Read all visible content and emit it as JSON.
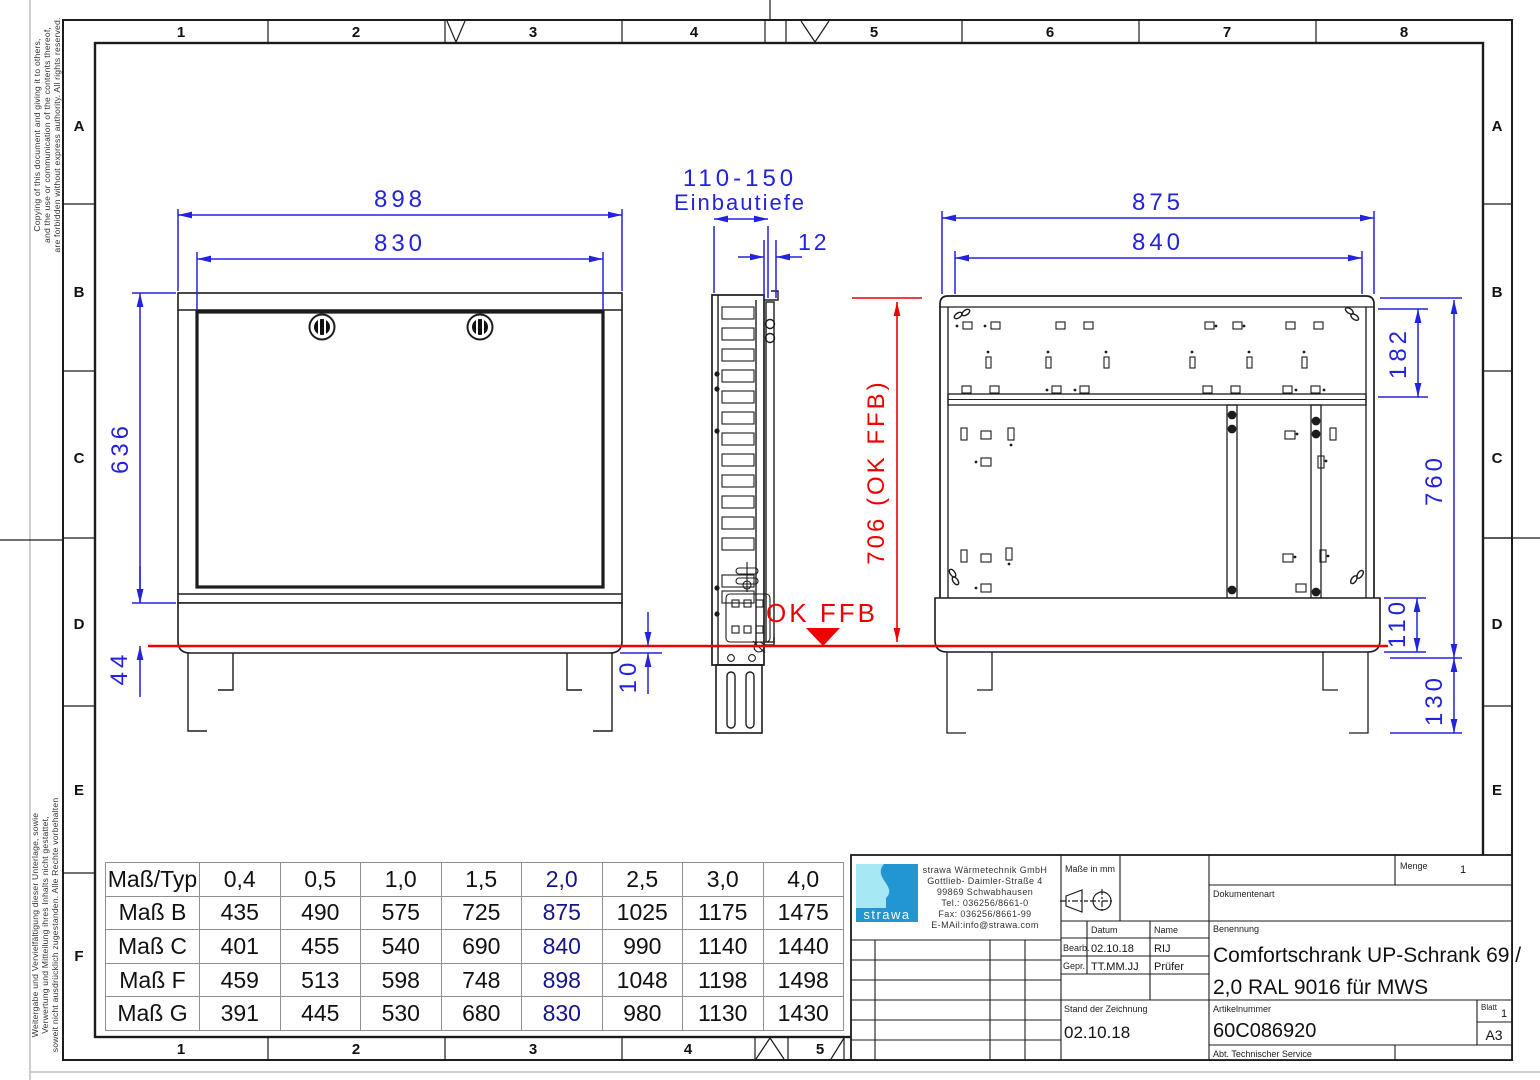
{
  "colors": {
    "dim_blue": "#2323dd",
    "datum_red": "#ee0000",
    "table_highlight": "#14148c",
    "line": "#1c1c1c",
    "logo_cyan": "#a5e7f3",
    "logo_blue": "#2196d3"
  },
  "border": {
    "top_cols": [
      "1",
      "2",
      "3",
      "4",
      "5",
      "6",
      "7",
      "8"
    ],
    "bottom_cols": [
      "1",
      "2",
      "3",
      "4",
      "5"
    ],
    "left_rows": [
      "A",
      "B",
      "C",
      "D",
      "E",
      "F"
    ],
    "right_rows": [
      "A",
      "B",
      "C",
      "D",
      "E"
    ]
  },
  "notices": {
    "top_lines": [
      "Copying of this document and giving it to others,",
      "and the use or communication of the contents thereof,",
      "are forbidden without express authority. All rights reserved."
    ],
    "bottom_lines": [
      "Weitergabe und Vervielfältigung dieser Unterlage, sowie",
      "Verwertung und Mitteilung ihres Inhalts nicht gestattet,",
      "soweit nicht ausdrücklich zugestanden. Alle Rechte vorbehalten"
    ]
  },
  "front_view": {
    "dim_outer_width": "898",
    "dim_door_width": "830",
    "dim_height": "636",
    "dim_base": "44",
    "dim_floor_gap": "10"
  },
  "side_view": {
    "dim_depth": "110-150",
    "dim_depth_label": "Einbautiefe",
    "dim_door_thickness": "12"
  },
  "rear_view": {
    "dim_outer_width": "875",
    "dim_inner_width": "840",
    "dim_top_zone": "182",
    "dim_height": "760",
    "dim_base_height": "110",
    "dim_leg_height": "130"
  },
  "datum": {
    "height_label": "706 (OK FFB)",
    "floor_label": "OK FFB"
  },
  "size_table": {
    "header": [
      "Maß/Typ",
      "0,4",
      "0,5",
      "1,0",
      "1,5",
      "2,0",
      "2,5",
      "3,0",
      "4,0"
    ],
    "rows": [
      {
        "label": "Maß B",
        "values": [
          "435",
          "490",
          "575",
          "725",
          "875",
          "1025",
          "1175",
          "1475"
        ]
      },
      {
        "label": "Maß C",
        "values": [
          "401",
          "455",
          "540",
          "690",
          "840",
          "990",
          "1140",
          "1440"
        ]
      },
      {
        "label": "Maß F",
        "values": [
          "459",
          "513",
          "598",
          "748",
          "898",
          "1048",
          "1198",
          "1498"
        ]
      },
      {
        "label": "Maß G",
        "values": [
          "391",
          "445",
          "530",
          "680",
          "830",
          "980",
          "1130",
          "1430"
        ]
      }
    ],
    "highlighted_column": "2,0"
  },
  "title_block": {
    "logo_text": "strawa",
    "company_lines": [
      "strawa Wärmetechnik GmbH",
      "Gottlieb- Daimler-Straße 4",
      "99869 Schwabhausen",
      "Tel.: 036256/8661-0",
      "Fax: 036256/8661-99",
      "E-MAil:info@strawa.com"
    ],
    "units_label": "Maße in mm",
    "menge_label": "Menge",
    "menge_value": "1",
    "dokumentenart_label": "Dokumentenart",
    "datum_label": "Datum",
    "name_label": "Name",
    "bearb_label": "Bearb.",
    "bearb_datum": "02.10.18",
    "bearb_name": "RIJ",
    "gepr_label": "Gepr.",
    "gepr_datum": "TT.MM.JJ",
    "gepr_name": "Prüfer",
    "benennung_label": "Benennung",
    "benennung_line1": "Comfortschrank UP-Schrank 69 /",
    "benennung_line2": "2,0 RAL 9016 für MWS",
    "stand_label": "Stand der Zeichnung",
    "stand_value": "02.10.18",
    "artikel_label": "Artikelnummer",
    "artikel_value": "60C086920",
    "blatt_label": "Blatt",
    "blatt_value": "1",
    "format_value": "A3",
    "abt_label": "Abt. Technischer Service"
  }
}
